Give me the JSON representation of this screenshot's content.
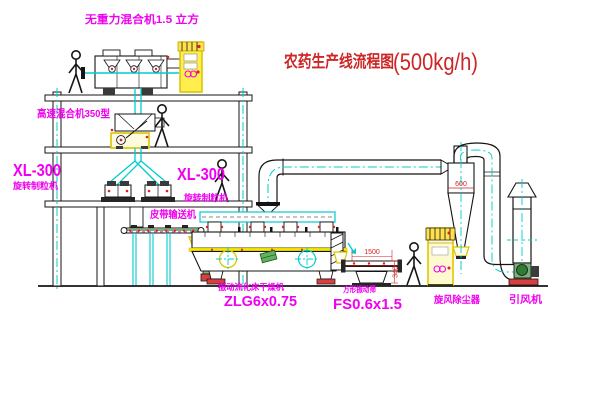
{
  "diagram": {
    "title": "农药生产线流程图",
    "capacity": "(500kg/h)"
  },
  "labels": {
    "gravity_mixer": "无重力混合机1.5 立方",
    "high_speed_mixer": "高速混合机350型",
    "granulator_left_model": "XL-300",
    "granulator_left_name": "旋转制粒机",
    "granulator_right_model": "XL-300",
    "granulator_right_name": "旋转制粒机",
    "belt_conveyor": "皮带输送机",
    "fluid_bed_dryer_name": "振动流化床干燥机",
    "fluid_bed_dryer_model": "ZLG6x0.75",
    "vibrating_screen_name": "方形振动筛",
    "vibrating_screen_model": "FS0.6x1.5",
    "cyclone_dust_collector": "旋风除尘器",
    "induced_draft_fan": "引风机"
  },
  "dimensions": {
    "cyclone_diameter": "600",
    "screen_length": "1500",
    "screen_height": "340"
  },
  "colors": {
    "label_magenta": "#f000f0",
    "title_red": "#cc2626",
    "dimension_red": "#d42222",
    "outline_black": "#141414",
    "centerline_cyan": "#00cccc",
    "highlight_yellow": "#f2dc00",
    "conveyor_green": "#009900",
    "motor_red": "#d84040",
    "background": "#ffffff"
  }
}
